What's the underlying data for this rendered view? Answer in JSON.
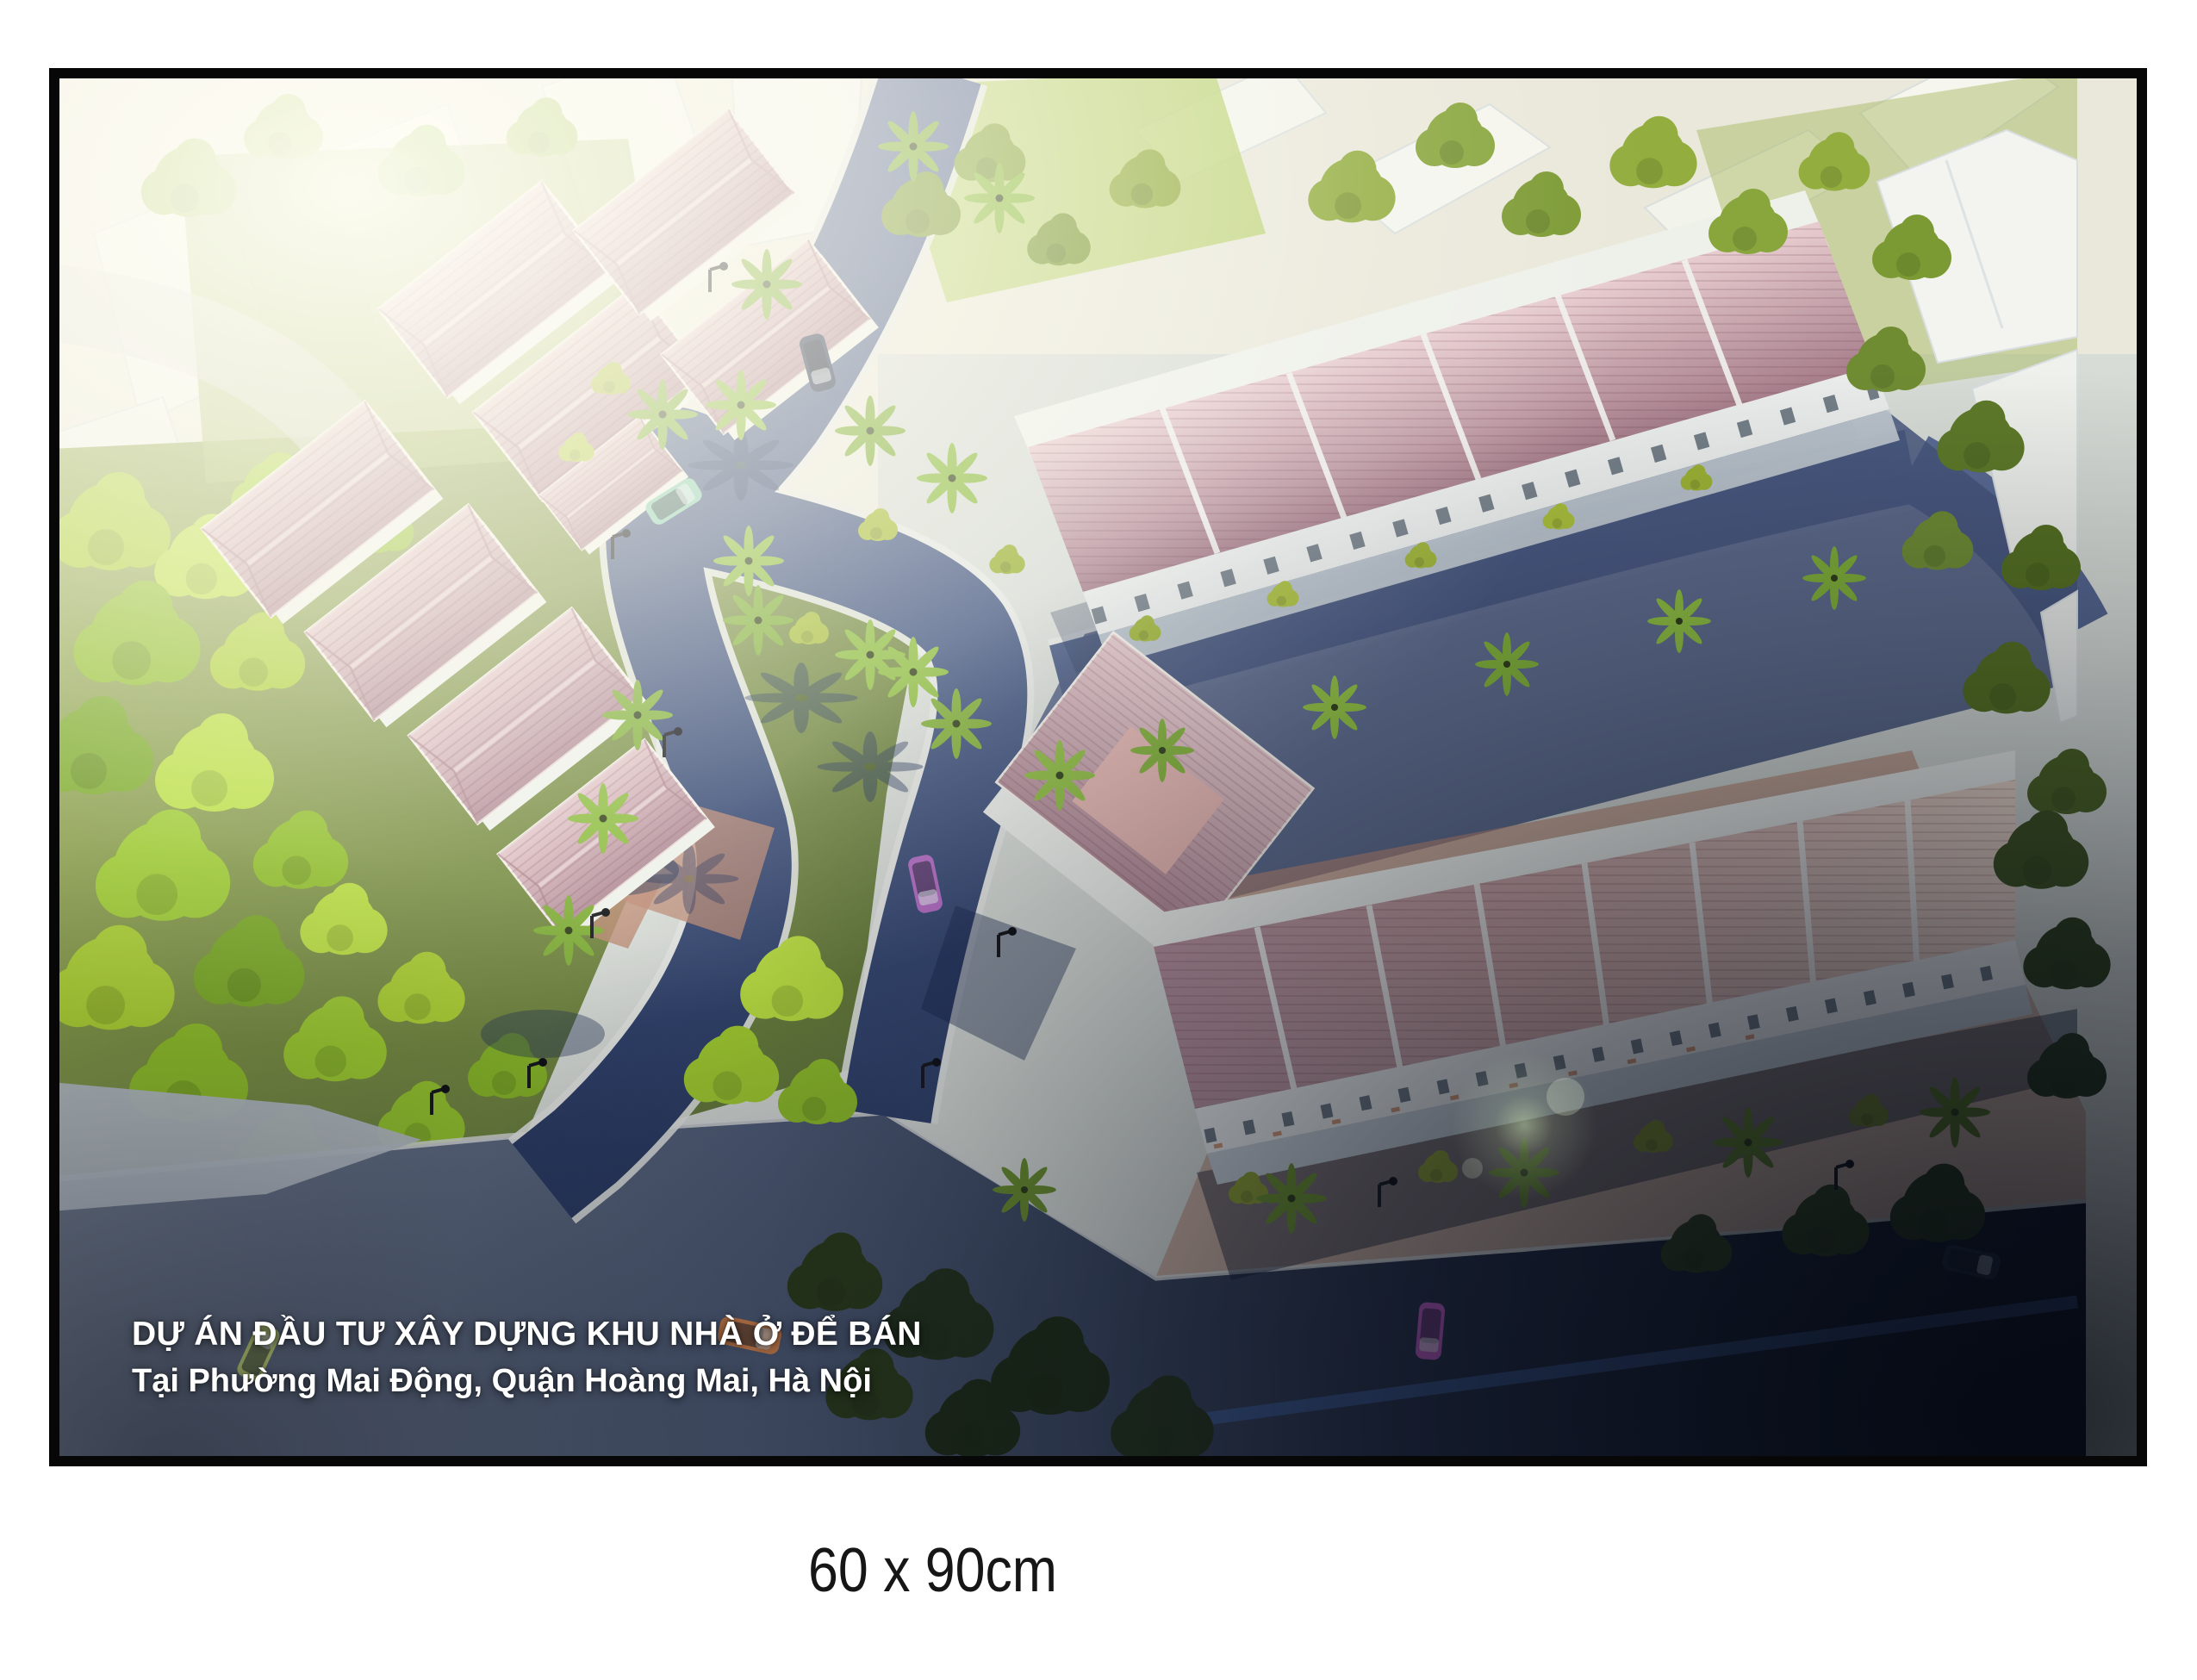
{
  "poster": {
    "description": "Aerial 3D architectural rendering of a residential housing project at dusk lighting, framed with a black border",
    "frame_color": "#070707",
    "caption": {
      "line1": "DỰ ÁN ĐẦU TƯ XÂY DỰNG KHU NHÀ Ở ĐỂ BÁN",
      "line2": "Tại Phường Mai Động, Quận Hoàng Mai, Hà Nội",
      "text_color": "#ffffff"
    },
    "palette": {
      "roof_pink": "#c49aa2",
      "roof_salmon": "#e8cfc0",
      "wall_white": "#f3f4ef",
      "road_blue": "#3d5178",
      "road_dark": "#141b29",
      "tree_bright_green": "#aace31",
      "tree_olive": "#7c9a33",
      "lawn_green": "#8aa04a",
      "paving_salmon": "#b9836d"
    },
    "cars": [
      {
        "name": "teal-hatchback",
        "color": "#8ccdb2"
      },
      {
        "name": "dark-suv",
        "color": "#2a354f"
      },
      {
        "name": "magenta-sedan-inner-road",
        "color": "#b56cc4"
      },
      {
        "name": "lime-car",
        "color": "#cfe07a"
      },
      {
        "name": "orange-car",
        "color": "#e08a4e"
      },
      {
        "name": "magenta-car-bottom",
        "color": "#c05ec6"
      },
      {
        "name": "dark-car-right",
        "color": "#222c40"
      }
    ]
  },
  "size_label": {
    "text": "60 x 90cm",
    "text_color": "#161616"
  }
}
